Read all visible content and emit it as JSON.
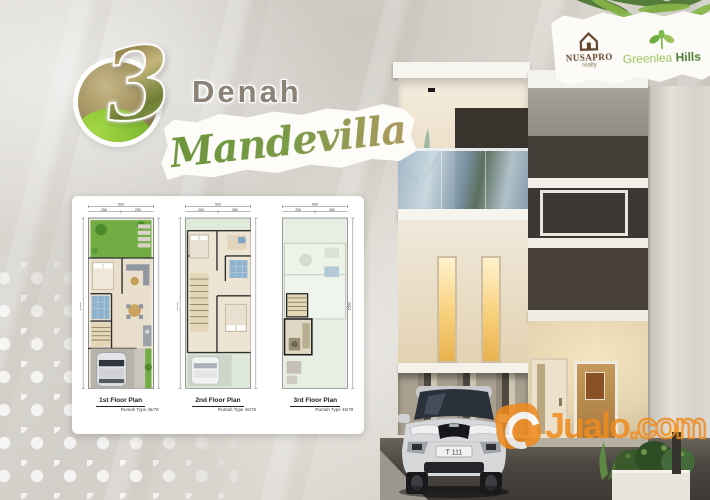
{
  "badge": {
    "number": "3",
    "title": "Denah",
    "name": "Mandevilla"
  },
  "logos": {
    "nusapro": {
      "name": "NUSAPRO",
      "tagline": "realty"
    },
    "greenlea": {
      "first": "Greenlea",
      "second": "Hills"
    }
  },
  "plans": [
    {
      "label": "1st Floor Plan",
      "sublabel": "Rumah Type 46/78"
    },
    {
      "label": "2nd Floor Plan",
      "sublabel": "Rumah Type 46/78"
    },
    {
      "label": "3rd Floor Plan",
      "sublabel": "Rumah Type 46/78"
    }
  ],
  "plan_dims": {
    "total": "500",
    "half_left": "250",
    "half_right": "250",
    "height": "1500"
  },
  "house": {
    "license_plate": "T 111"
  },
  "watermark": {
    "brand": "Jualo",
    "tld": ".com"
  },
  "colors": {
    "accent_green": "#7b9a44",
    "accent_gold": "#9c8c59",
    "watermark_orange": "#ef8c1e",
    "nusapro_brown": "#5f432c",
    "greenlea_light": "#9bc25b",
    "greenlea_dark": "#4e7d32"
  }
}
